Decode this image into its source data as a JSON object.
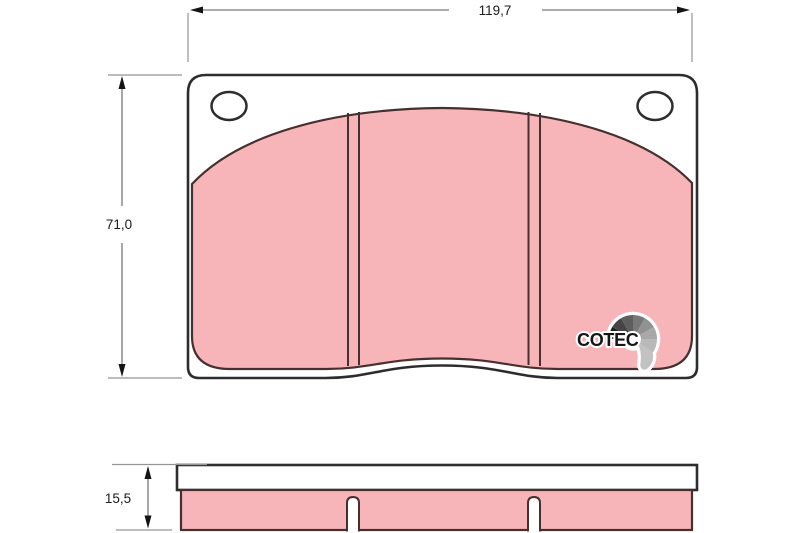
{
  "dimensions": {
    "width": "119,7",
    "height": "71,0",
    "thickness": "15,5"
  },
  "logo": {
    "text": "COTEC"
  },
  "colors": {
    "background": "#ffffff",
    "friction_material": "#f8b5b9",
    "friction_outline": "#46302e",
    "plate_fill": "#ffffff",
    "plate_outline": "#2d2d2d",
    "dimension_line": "#7a7a7a",
    "dimension_text": "#1b1b1b",
    "logo_text": "#161616",
    "logo_fan_grays": [
      "#1f1f1f",
      "#454545",
      "#5e5e5e",
      "#787878",
      "#929292",
      "#a8a8a8",
      "#b9b9b9",
      "#c2c2c2"
    ]
  }
}
